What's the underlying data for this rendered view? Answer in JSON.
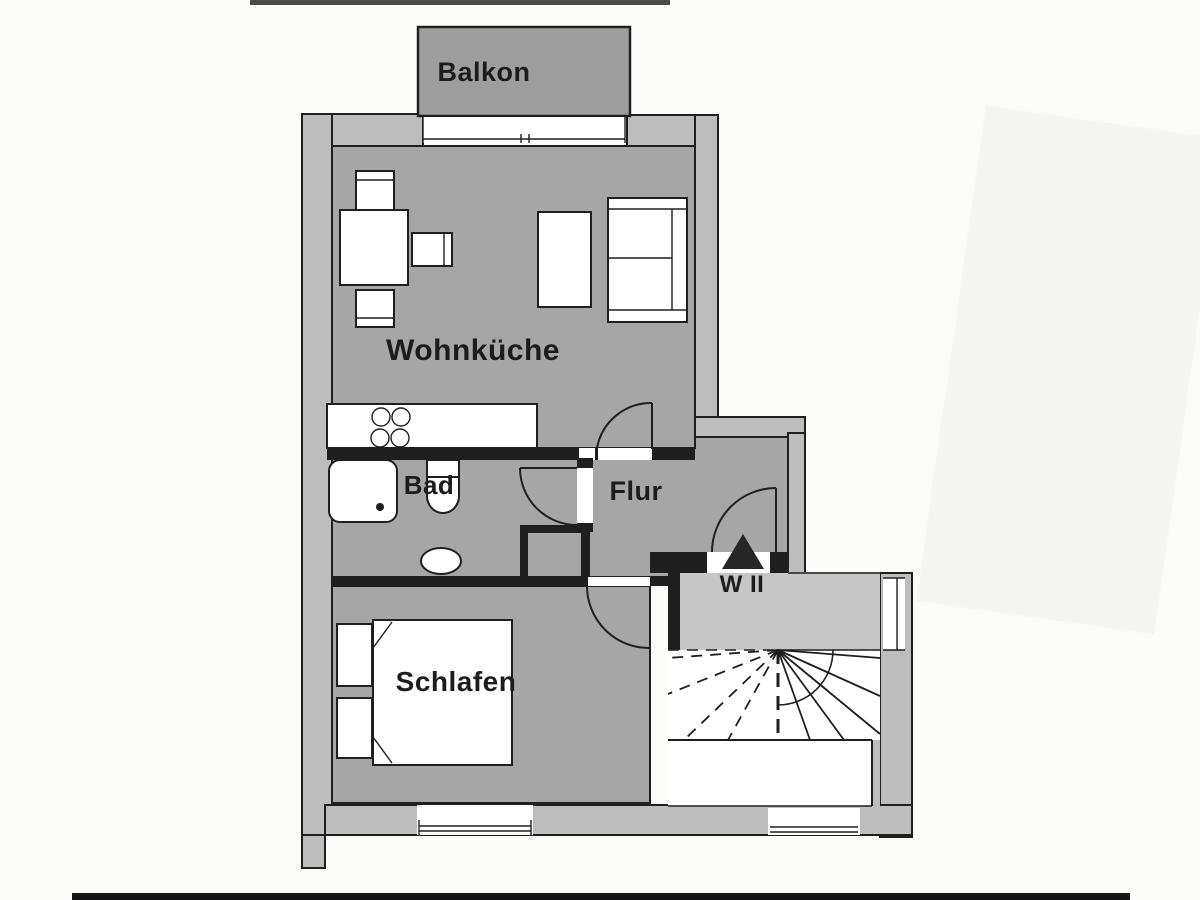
{
  "plan": {
    "title_hint": "apartment floor plan (scanned)",
    "labels": {
      "balkon": "Balkon",
      "wohnkueche": "Wohnküche",
      "bad": "Bad",
      "flur": "Flur",
      "schlafen": "Schlafen",
      "unit": "W II"
    },
    "fixtures": [
      "dining-table",
      "chair",
      "chair",
      "armchair",
      "side-table",
      "sofa",
      "kitchen-counter",
      "stove-burners",
      "shower",
      "toilet",
      "sink",
      "double-bed",
      "nightstand",
      "nightstand",
      "winder-staircase",
      "entrance-arrow"
    ],
    "colors": {
      "floor": "#a6a6a6",
      "wall": "#bdbdbd",
      "balcony": "#9e9e9e",
      "landing": "#c6c6c6",
      "line": "#1f1f1f",
      "fixture": "#ffffff",
      "paper": "#fbfbfa",
      "ink": "#1c1c1c"
    }
  }
}
